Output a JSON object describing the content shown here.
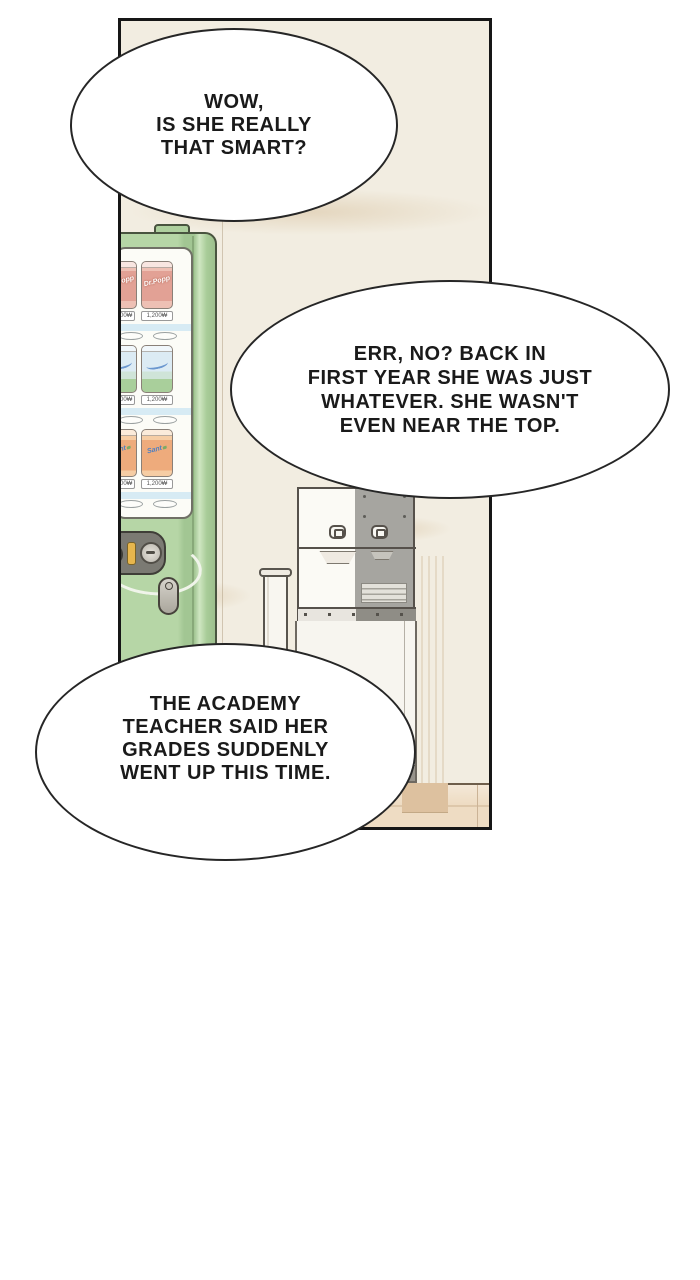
{
  "bubbles": [
    {
      "lines": [
        "WOW,",
        "IS SHE REALLY",
        "THAT SMART?"
      ]
    },
    {
      "lines": [
        "ERR, NO? BACK IN",
        "FIRST YEAR SHE WAS JUST",
        "WHATEVER. SHE WASN'T",
        "EVEN NEAR THE TOP."
      ]
    },
    {
      "lines": [
        "THE ACADEMY",
        "TEACHER SAID HER",
        "GRADES SUDDENLY",
        "WENT UP THIS TIME."
      ]
    }
  ],
  "vending": {
    "rows": [
      {
        "brand": "Dr.Popp",
        "price": "1,200₩"
      },
      {
        "brand": "",
        "price": "1,200₩"
      },
      {
        "brand": "Sant",
        "price": "1,200₩"
      }
    ]
  },
  "colors": {
    "machine_green": "#b6d6a6",
    "wall_cream": "#f2ede1",
    "floor_wood": "#eedcc3",
    "can_row1": "#e2a195",
    "can_row2": "#dcebf4",
    "can_row3": "#eeab7c",
    "dispenser_gray": "#a6a5a0",
    "bubble_outline": "#262626"
  }
}
